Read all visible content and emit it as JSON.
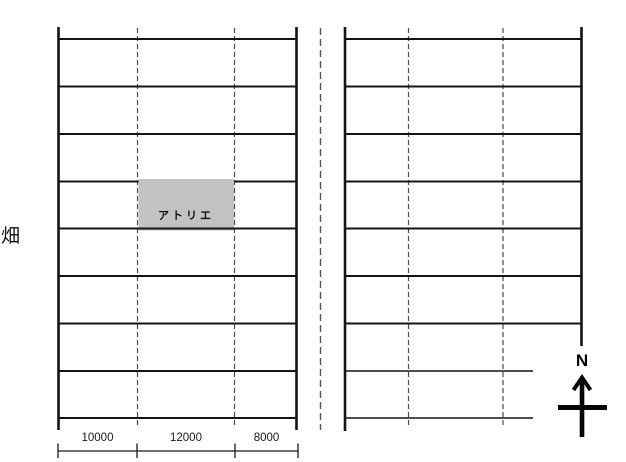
{
  "site_plan": {
    "left_area_label": "畑",
    "building": {
      "label": "アトリエ",
      "fill_color": "#c2c2c2"
    },
    "compass": {
      "label": "N"
    },
    "dimension_scale": {
      "segments": [
        {
          "label": "10000"
        },
        {
          "label": "12000"
        },
        {
          "label": "8000"
        }
      ]
    },
    "colors": {
      "solid_line": "#141414",
      "dashed_line": "#4a4a4a",
      "road_centerline": "#555555",
      "background": "#ffffff"
    }
  }
}
